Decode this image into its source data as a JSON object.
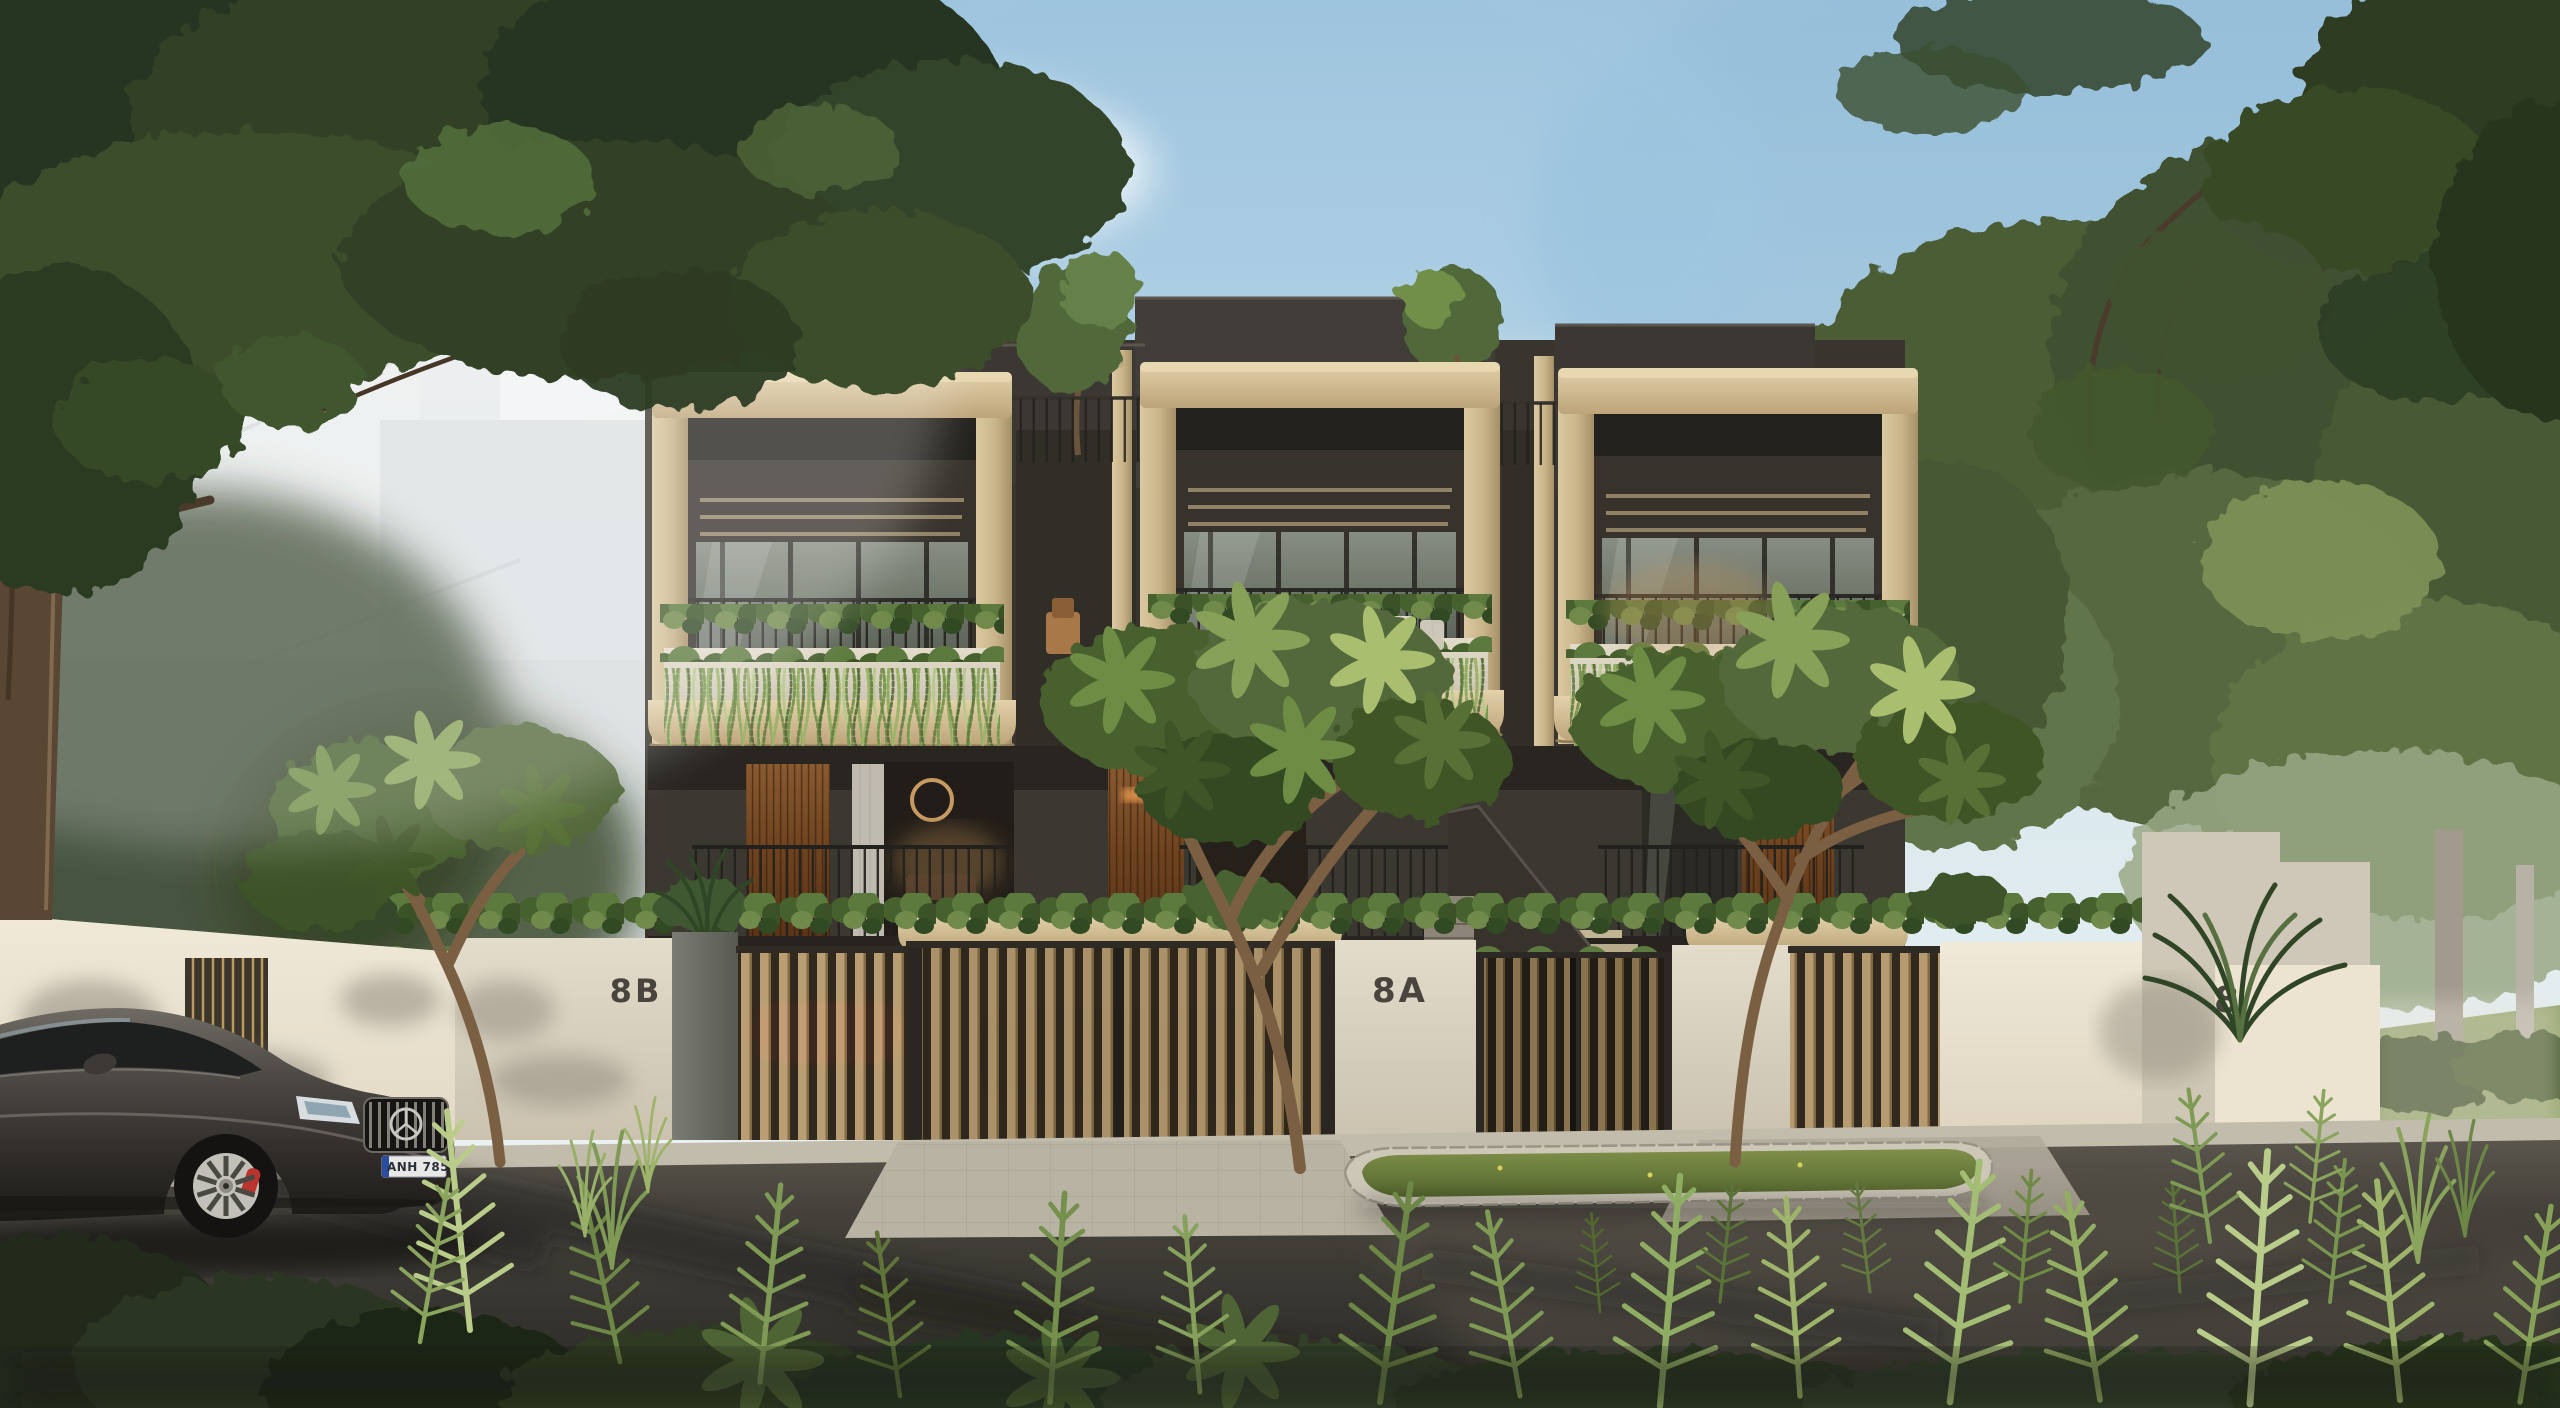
{
  "house_numbers": {
    "unit_left": "8B",
    "unit_middle": "8A",
    "unit_right": "8"
  },
  "vehicle": {
    "license_plate": "ANH 785"
  },
  "palette": {
    "sky_blue": "#9fc3dc",
    "sky_haze": "#eef3f4",
    "cloud": "#ffffff",
    "concrete_frame": "#cdb88e",
    "concrete_light": "#e3d2ab",
    "concrete_shadow": "#97835f",
    "facade_charcoal": "#3e3a33",
    "facade_dark": "#2a2723",
    "glass_cool": "#767d74",
    "glass_warm_glow": "#c89a5e",
    "stone_wall": "#ddd5c5",
    "stone_pillar": "#6e6f68",
    "timber_slat": "#c9ab7c",
    "timber_panel": "#7d5127",
    "foliage_dark": "#2c3a21",
    "foliage_mid": "#53683a",
    "foliage_light": "#87a258",
    "foliage_bright": "#b9cc8a",
    "lawn": "#93a36b",
    "grass_island": "#6d7f44",
    "road_asphalt": "#44413a",
    "paver": "#b9b3a4",
    "car_paint": "#4a4642",
    "brake_caliper": "#b8342c",
    "red_car_glimpse": "#8e2420",
    "plate_band": "#2a4da0",
    "ghost_building": "#e7e9ea"
  }
}
